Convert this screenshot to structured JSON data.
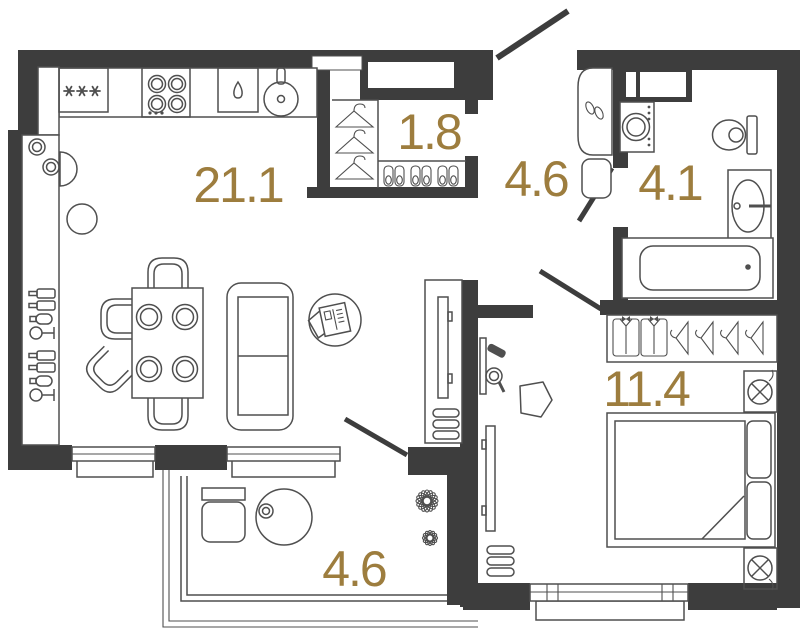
{
  "floor_plan": {
    "room_labels": {
      "living_kitchen": "21.1",
      "closet": "1.8",
      "hallway": "4.6",
      "bathroom": "4.1",
      "bedroom": "11.4",
      "balcony": "4.6"
    },
    "colors": {
      "wall": "#3d3d3d",
      "furniture_line": "#4f4f4f",
      "room_label": "#9d7d3e",
      "background": "#ffffff"
    }
  }
}
